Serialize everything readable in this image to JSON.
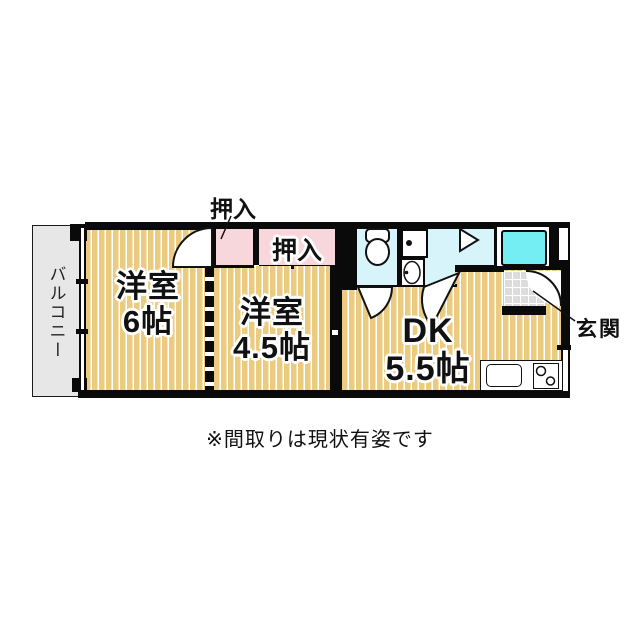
{
  "colors": {
    "background": "#FFFFFF",
    "tatami": "#EBCB7F",
    "tatami_line": "#FFFFFF",
    "closet_pink": "#F8D7DC",
    "wet_area_cyan": "#D6F4FA",
    "bathtub_cyan": "#74EDF3",
    "balcony_gray": "#E7E7E7",
    "entrance_tile_gray": "#DCDCDC",
    "wall_black": "#0A0A0A"
  },
  "labels": {
    "balcony": "バルコニー",
    "oshiire_top": "押入",
    "oshiire_inner": "押入",
    "room6_name": "洋室",
    "room6_size": "6帖",
    "room45_name": "洋室",
    "room45_size": "4.5帖",
    "dk_name": "DK",
    "dk_size": "5.5帖",
    "entrance": "玄関",
    "note": "※間取りは現状有姿です"
  }
}
